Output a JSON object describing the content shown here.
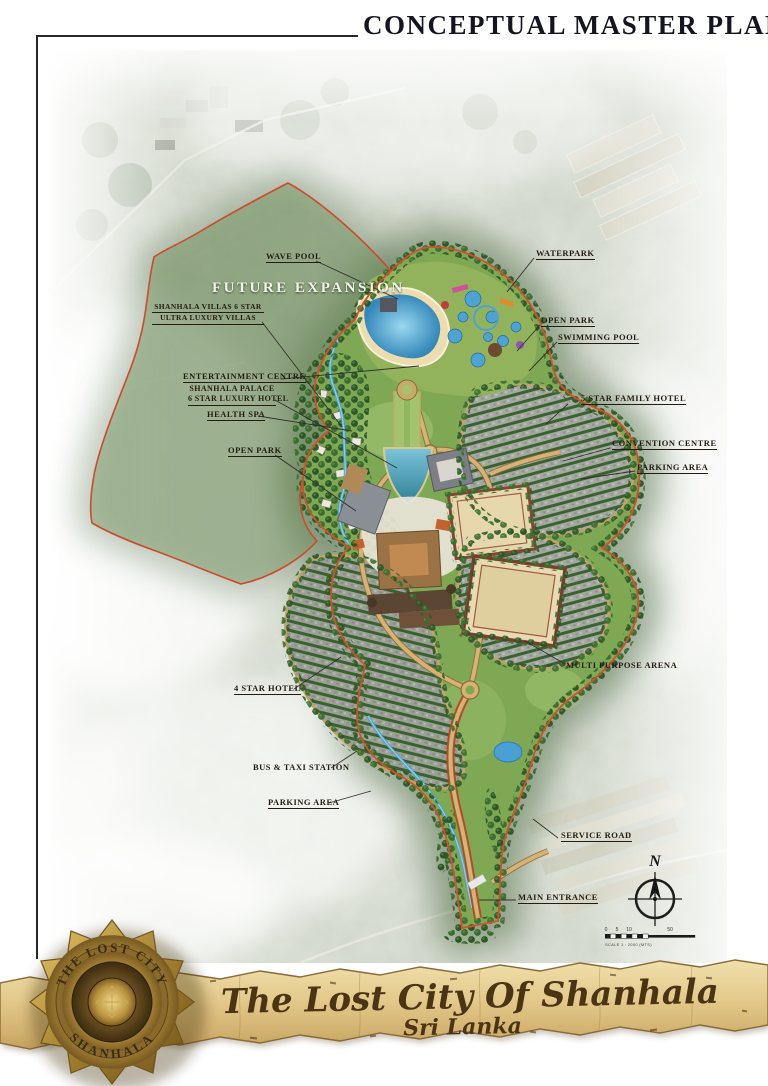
{
  "header": {
    "title": "CONCEPTUAL MASTER PLAN"
  },
  "map": {
    "future_expansion": "FUTURE EXPANSION",
    "labels": {
      "wave_pool": "WAVE POOL",
      "shanhala_villas_line1": "SHANHALA VILLAS 6 STAR",
      "shanhala_villas_line2": "ULTRA LUXURY VILLAS",
      "entertainment_centre": "ENTERTAINMENT CENTRE",
      "shanhala_palace_line1": "SHANHALA PALACE",
      "shanhala_palace_line2": "6 STAR LUXURY HOTEL",
      "health_spa": "HEALTH SPA",
      "open_park_left": "OPEN PARK",
      "waterpark": "WATERPARK",
      "open_park_right": "OPEN PARK",
      "swimming_pool": "SWIMMING POOL",
      "five_star_family_hotel": "5 STAR FAMILY HOTEL",
      "convention_centre": "CONVENTION CENTRE",
      "parking_area_right": "PARKING AREA",
      "multi_purpose_arena": "MULTI PURPOSE ARENA",
      "four_star_hotel": "4 STAR HOTEL",
      "bus_taxi_station": "BUS & TAXI STATION",
      "parking_area_lower": "PARKING AREA",
      "service_road": "SERVICE ROAD",
      "main_entrance": "MAIN ENTRANCE"
    }
  },
  "compass": {
    "north": "N"
  },
  "scale": {
    "ticks": [
      "0",
      "5",
      "10",
      "50"
    ],
    "caption": "SCALE 1 : 2000 (MTS)"
  },
  "banner": {
    "title": "The Lost City Of Shanhala",
    "subtitle": "Sri Lanka"
  },
  "medallion": {
    "arc_top": "THE LOST CITY",
    "arc_bottom": "SHANHALA"
  },
  "colors": {
    "boundary": "#cc4a2c",
    "site_green": "#7fa855",
    "water": "#4aa0d2",
    "parchment": "#dcbe7c",
    "gold": "#b8913f",
    "title_ink": "#15151f",
    "label_ink": "#241c12"
  }
}
